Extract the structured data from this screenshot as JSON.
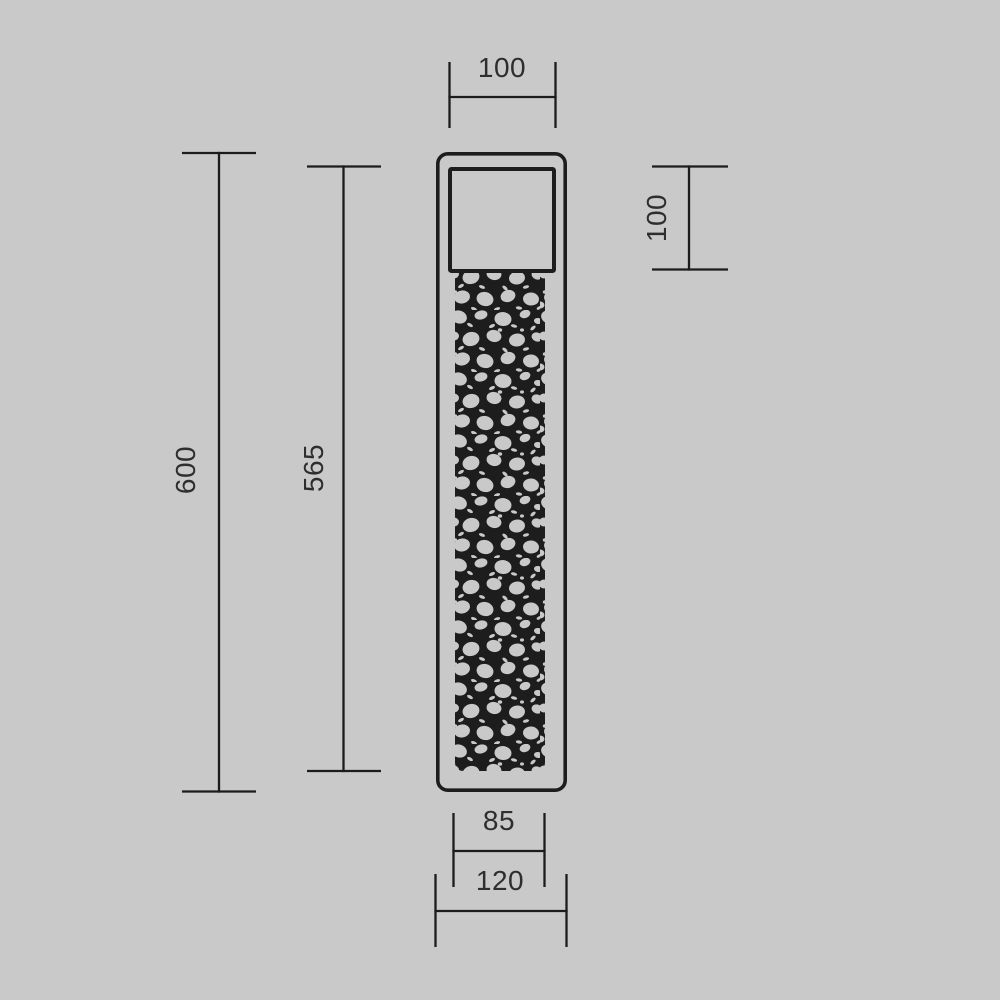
{
  "drawing": {
    "kind": "technical-dimension-drawing",
    "colors": {
      "background": "#c9c9c9",
      "line": "#1c1c1c",
      "label": "#2e2e2e",
      "perforation_fill": "#1d1d1d",
      "perforation_hole": "#c9c9c9"
    },
    "dimensions": {
      "top_width": "100",
      "head_height": "100",
      "overall_height": "600",
      "inner_height": "565",
      "body_width": "85",
      "base_width": "120"
    }
  }
}
